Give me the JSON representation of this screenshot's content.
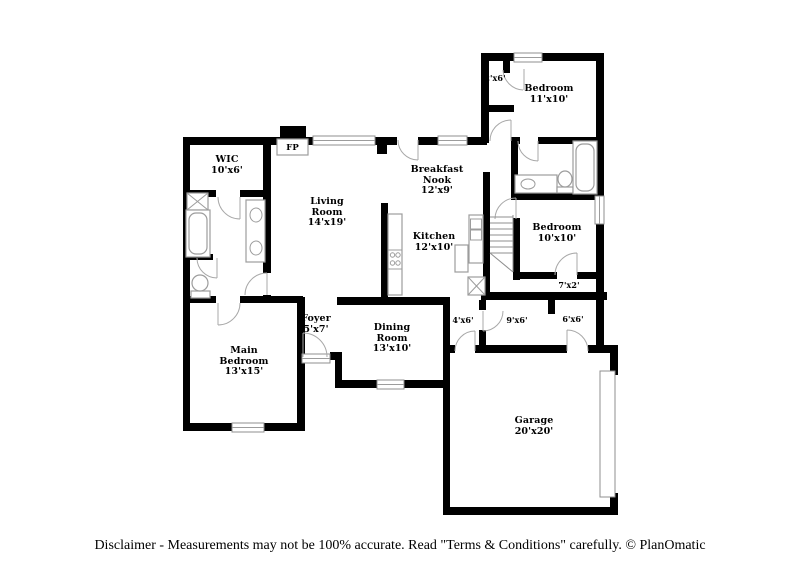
{
  "floorplan": {
    "fireplace_label": "FP",
    "rooms": {
      "wic": {
        "name": "WIC",
        "dims": "10'x6'"
      },
      "living_room": {
        "name": "Living Room",
        "dims": "14'x19'"
      },
      "breakfast_nook": {
        "name": "Breakfast Nook",
        "dims": "12'x9'"
      },
      "bedroom_top_right": {
        "name": "Bedroom",
        "dims": "11'x10'"
      },
      "closet_bedroom_top": {
        "name": "",
        "dims": "2'x6'"
      },
      "kitchen": {
        "name": "Kitchen",
        "dims": "12'x10'"
      },
      "bedroom_right": {
        "name": "Bedroom",
        "dims": "10'x10'"
      },
      "closet_bedroom_right": {
        "name": "",
        "dims": "7'x2'"
      },
      "foyer": {
        "name": "Foyer",
        "dims": "5'x7'"
      },
      "dining_room": {
        "name": "Dining Room",
        "dims": "13'x10'"
      },
      "utility_left": {
        "name": "",
        "dims": "4'x6'"
      },
      "hall": {
        "name": "",
        "dims": "9'x6'"
      },
      "utility_right": {
        "name": "",
        "dims": "6'x6'"
      },
      "main_bedroom": {
        "name": "Main Bedroom",
        "dims": "13'x15'"
      },
      "garage": {
        "name": "Garage",
        "dims": "20'x20'"
      }
    }
  },
  "footer": {
    "disclaimer": "Disclaimer - Measurements may not be 100% accurate. Read \"Terms & Conditions\" carefully. © PlanOmatic"
  }
}
